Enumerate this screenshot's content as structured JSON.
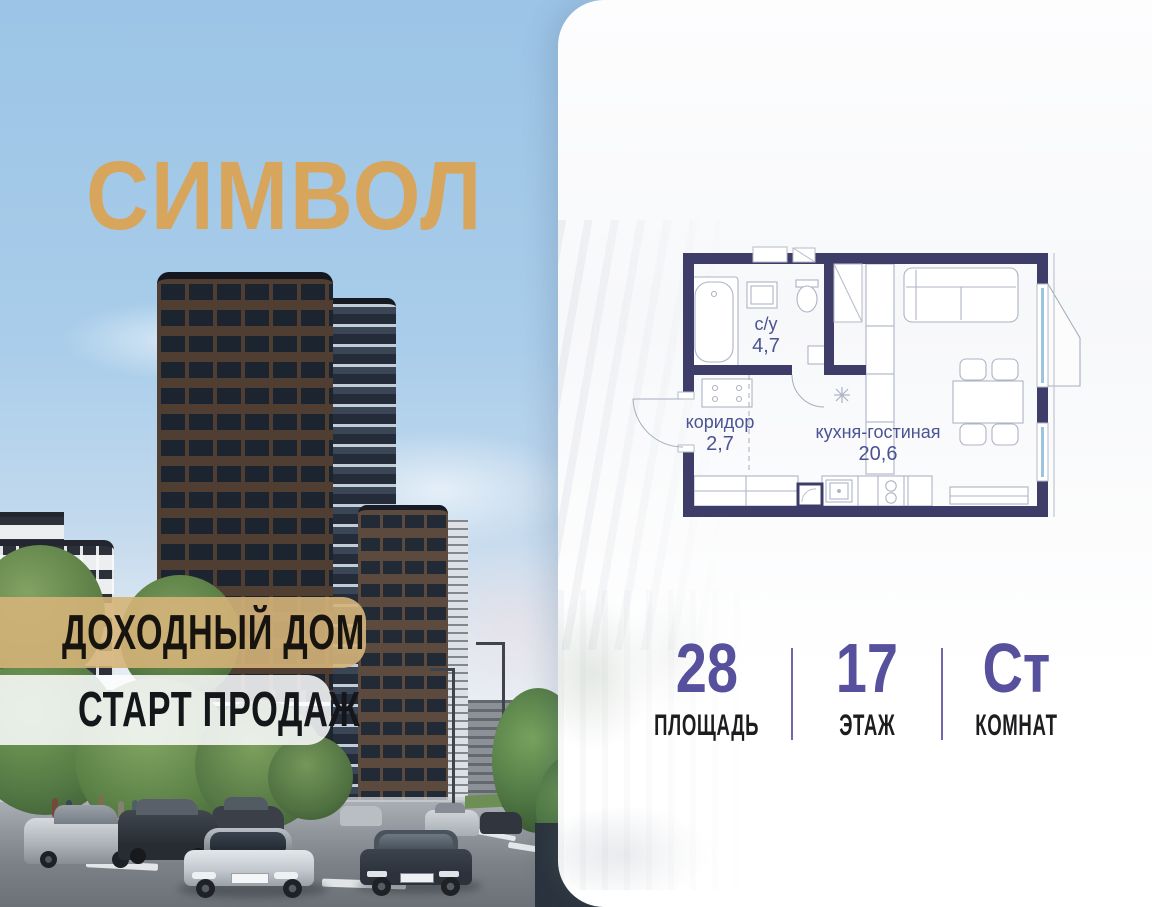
{
  "brand": {
    "logo_text": "СИМВОЛ"
  },
  "banners": {
    "line1": "ДОХОДНЫЙ ДОМ",
    "line2": "СТАРТ ПРОДАЖ"
  },
  "floorplan": {
    "rooms": [
      {
        "name": "с/у",
        "area": "4,7"
      },
      {
        "name": "коридор",
        "area": "2,7"
      },
      {
        "name": "кухня-гостиная",
        "area": "20,6"
      }
    ]
  },
  "stats": {
    "area": {
      "value": "28",
      "label": "ПЛОЩАДЬ"
    },
    "floor": {
      "value": "17",
      "label": "ЭТАЖ"
    },
    "rooms": {
      "value": "Ст",
      "label": "КОМНАТ"
    }
  },
  "colors": {
    "accent_gold": "#d7a55c",
    "accent_purple": "#57509c",
    "plan_wall": "#3e3c68",
    "plan_label": "#4a5394",
    "banner_gold": "#d5b479",
    "sky": "#a3c7e8"
  }
}
